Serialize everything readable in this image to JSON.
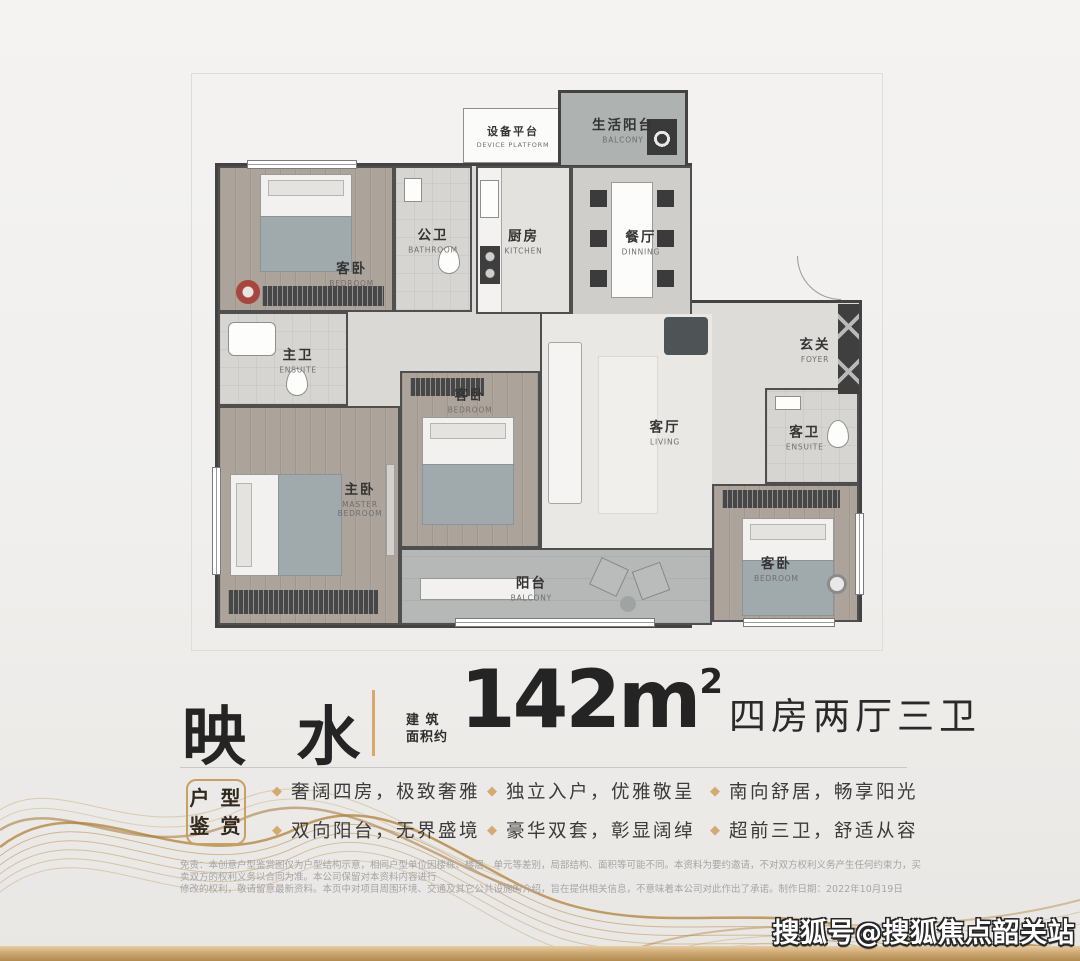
{
  "plan": {
    "device_platform": {
      "zh": "设备平台",
      "en": "DEVICE PLATFORM"
    },
    "life_balcony": {
      "zh": "生活阳台",
      "en": "BALCONY"
    },
    "bedroom_a": {
      "zh": "客卧",
      "en": "BEDROOM"
    },
    "public_bath": {
      "zh": "公卫",
      "en": "BATHROOM"
    },
    "kitchen": {
      "zh": "厨房",
      "en": "KITCHEN"
    },
    "dining": {
      "zh": "餐厅",
      "en": "DINNING"
    },
    "foyer": {
      "zh": "玄关",
      "en": "FOYER"
    },
    "master_bath": {
      "zh": "主卫",
      "en": "ENSUITE"
    },
    "master_bedroom": {
      "zh": "主卧",
      "en": "MASTER BEDROOM"
    },
    "bedroom_b": {
      "zh": "客卧",
      "en": "BEDROOM"
    },
    "living": {
      "zh": "客厅",
      "en": "LIVING"
    },
    "guest_bath": {
      "zh": "客卫",
      "en": "ENSUITE"
    },
    "bedroom_c": {
      "zh": "客卧",
      "en": "BEDROOM"
    },
    "balcony": {
      "zh": "阳台",
      "en": "BALCONY"
    }
  },
  "title": {
    "project_name": "映 水",
    "area_label_line1": "建 筑",
    "area_label_line2": "面积约",
    "area_number": "142m",
    "area_superscript": "2",
    "layout_text": "四房两厅三卫"
  },
  "features": {
    "badge_line1": "户 型",
    "badge_line2": "鉴 赏",
    "bullet_glyph": "◆",
    "columns": [
      {
        "items": [
          "奢阔四房，极致奢雅",
          "双向阳台，无界盛境"
        ]
      },
      {
        "items": [
          "独立入户，优雅敬呈",
          "豪华双套，彰显阔绰"
        ]
      },
      {
        "items": [
          "南向舒居，畅享阳光",
          "超前三卫，舒适从容"
        ]
      }
    ]
  },
  "disclaimer": {
    "line1": "免责：本创意户型鉴赏图仅为户型结构示意，相同户型单位因楼栋、楼层、单元等差别，局部结构、面积等可能不同。本资料为要约邀请，不对双方权利义务产生任何约束力，买卖双方的权利义务以合同为准。本公司保留对本资料内容进行",
    "line2": "修改的权利，敬请留意最新资料。本页中对项目周围环境、交通及其它公共设施的介绍，旨在提供相关信息，不意味着本公司对此作出了承诺。制作日期：2022年10月19日"
  },
  "watermark": {
    "text": "搜狐号@搜狐焦点韶关站"
  },
  "colors": {
    "accent_gold": "#c9a063",
    "divider_gold": "#d9a869",
    "wall_dark": "#434343",
    "text_dark": "#2a2a2a",
    "disclaimer_gray": "#a5a5a5"
  }
}
